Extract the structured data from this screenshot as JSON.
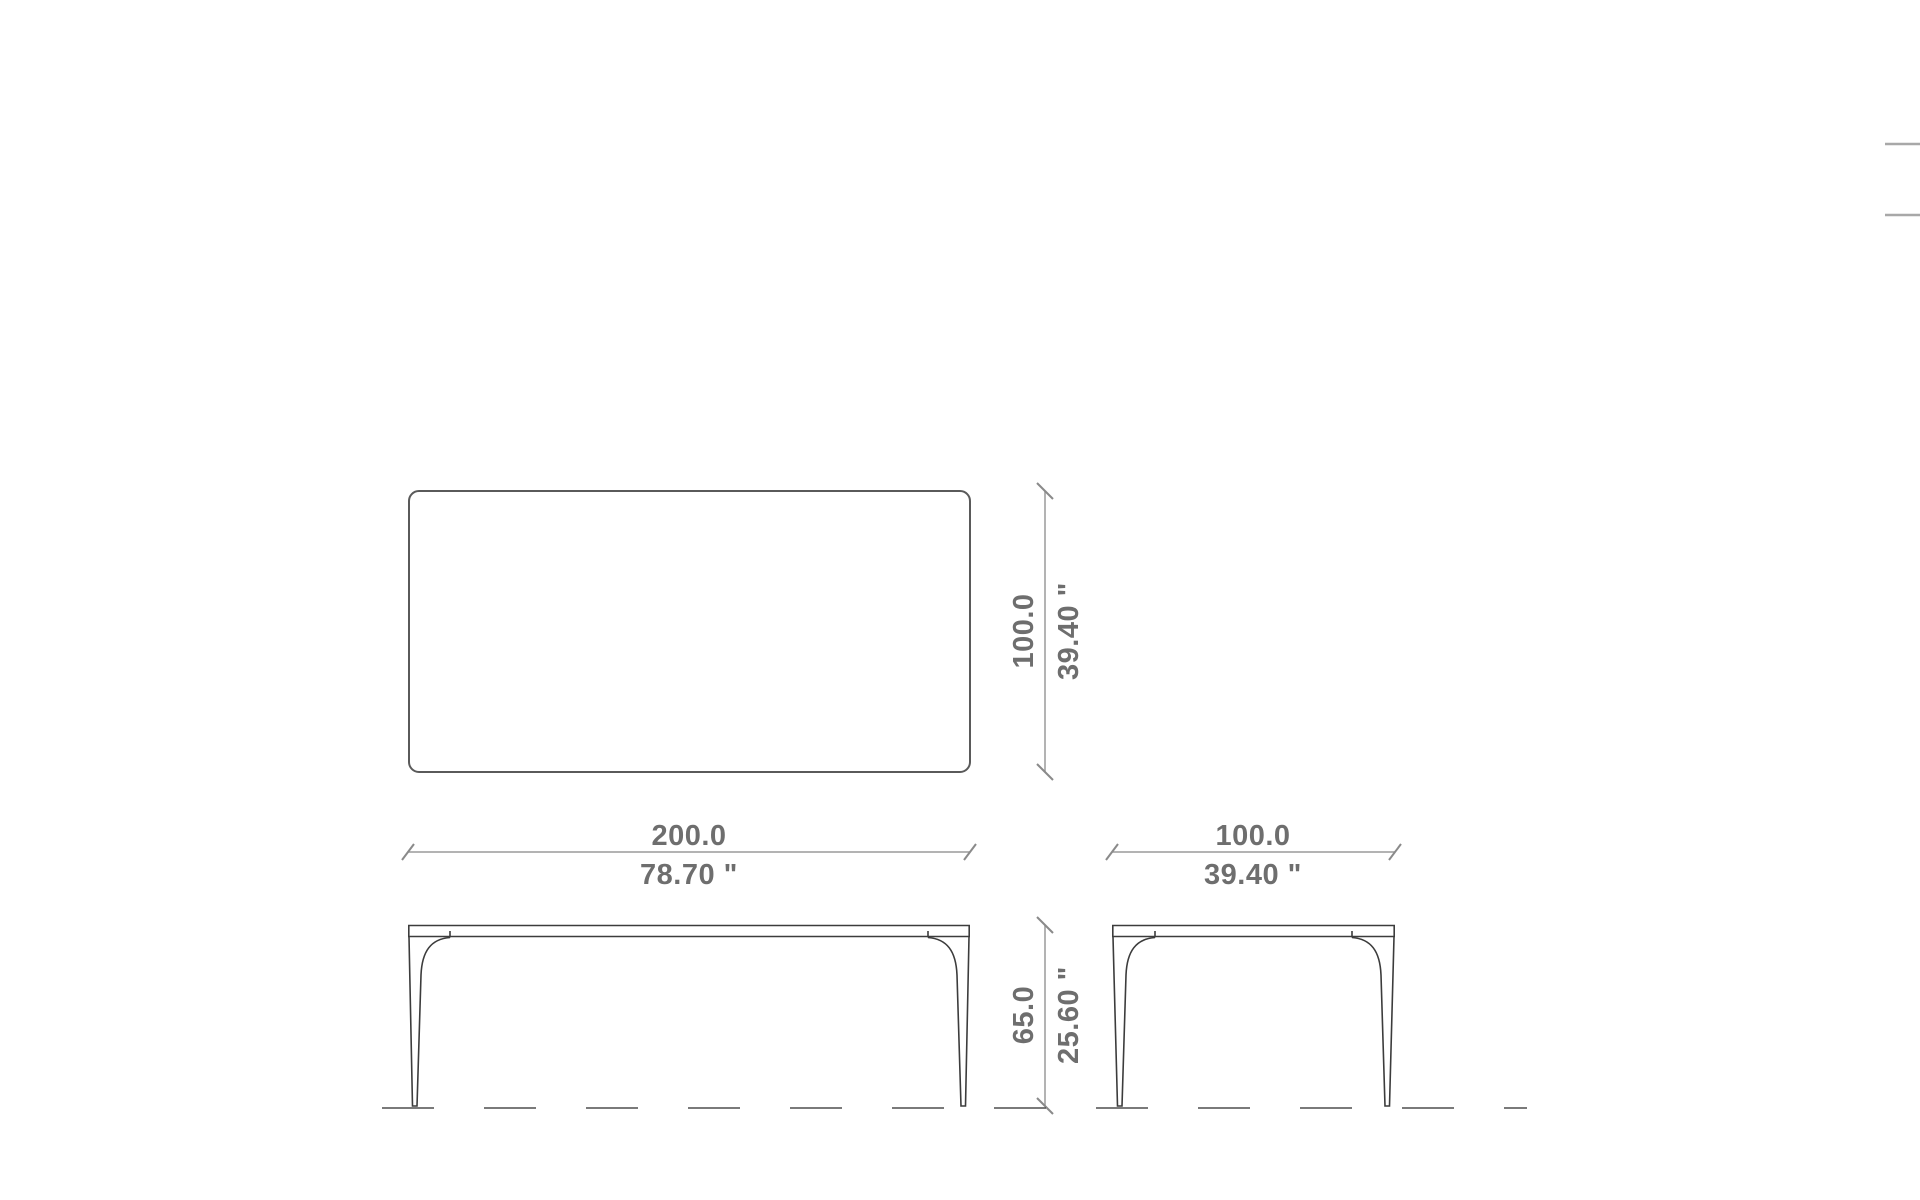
{
  "page": {
    "background": "#ffffff"
  },
  "drawing": {
    "colors": {
      "plan_outline": "#5a5a5a",
      "elevation_lines": "#3c3c3c",
      "dimension_lines": "#9a9a9a",
      "dimension_text": "#6e6e6e",
      "ground_line": "#4f4f4f",
      "edge_fragments": "#a8a8a8"
    }
  },
  "dimensions": {
    "top_width": {
      "metric": "200.0",
      "imperial": "78.70 \""
    },
    "top_depth": {
      "metric": "100.0",
      "imperial": "39.40 \""
    },
    "side_width": {
      "metric": "100.0",
      "imperial": "39.40 \""
    },
    "height": {
      "metric": "65.0",
      "imperial": "25.60 \""
    }
  }
}
